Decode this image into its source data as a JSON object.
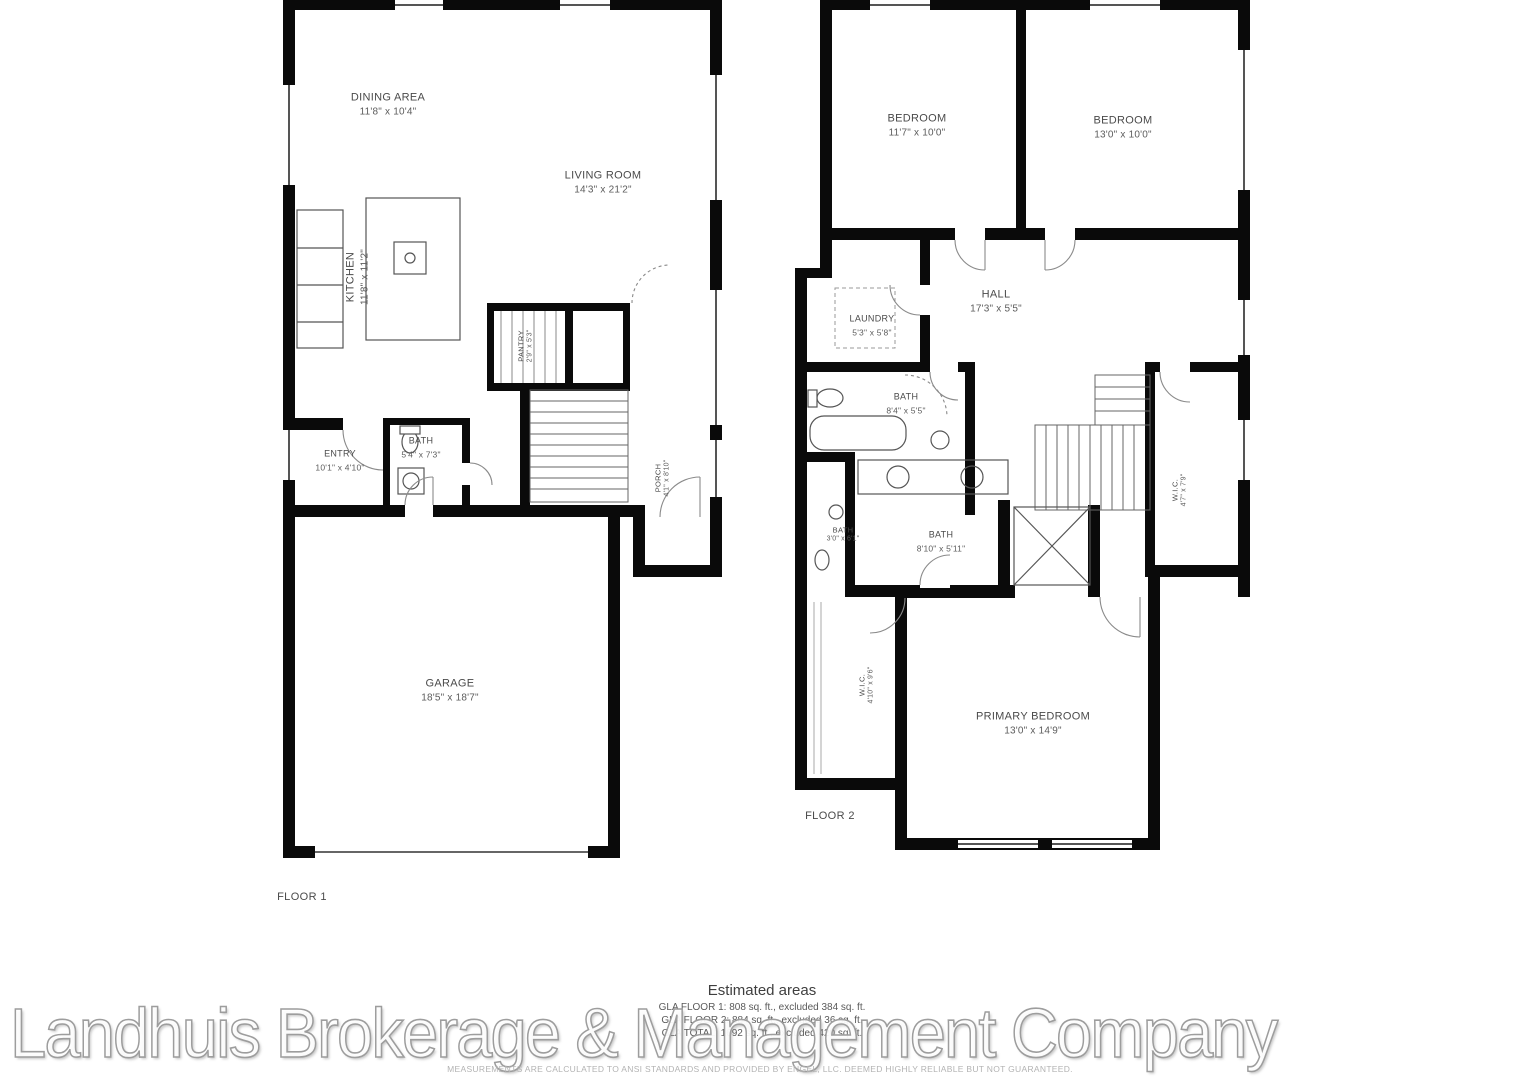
{
  "floor1": {
    "label": "FLOOR 1",
    "rooms": [
      {
        "label": "DINING AREA",
        "dims": "11'8\" x 10'4\""
      },
      {
        "label": "LIVING ROOM",
        "dims": "14'3\" x 21'2\""
      },
      {
        "label": "KITCHEN",
        "dims": "11'8\" x 11'2\""
      },
      {
        "label": "PANTRY",
        "dims": "2'9\" x 5'3\""
      },
      {
        "label": "BATH",
        "dims": "5'4\" x 7'3\""
      },
      {
        "label": "ENTRY",
        "dims": "10'1\" x 4'10\""
      },
      {
        "label": "PORCH",
        "dims": "4'1\" x 8'10\""
      },
      {
        "label": "GARAGE",
        "dims": "18'5\" x 18'7\""
      }
    ]
  },
  "floor2": {
    "label": "FLOOR 2",
    "rooms": [
      {
        "label": "BEDROOM",
        "dims": "11'7\" x 10'0\""
      },
      {
        "label": "BEDROOM",
        "dims": "13'0\" x 10'0\""
      },
      {
        "label": "LAUNDRY",
        "dims": "5'3\" x 5'8\""
      },
      {
        "label": "HALL",
        "dims": "17'3\" x 5'5\""
      },
      {
        "label": "BATH",
        "dims": "8'4\" x 5'5\""
      },
      {
        "label": "BATH",
        "dims": "3'0\" x 6'1\""
      },
      {
        "label": "BATH",
        "dims": "8'10\" x 5'11\""
      },
      {
        "label": "W.I.C.",
        "dims": "4'7\" x 7'9\""
      },
      {
        "label": "W.I.C.",
        "dims": "4'10\" x 9'6\""
      },
      {
        "label": "PRIMARY BEDROOM",
        "dims": "13'0\" x 14'9\""
      }
    ]
  },
  "footer": {
    "estimated_title": "Estimated areas",
    "lines": [
      "GLA FLOOR 1: 808 sq. ft., excluded 384 sq. ft.",
      "GLA FLOOR 2: 884 sq. ft., excluded 36 sq. ft.",
      "GLA TOTAL: 1692 sq. ft., excluded 420 sq. ft."
    ],
    "disclaimer": "MEASUREMENTS ARE CALCULATED TO ANSI STANDARDS AND PROVIDED BY ENGEL, LLC. DEEMED HIGHLY RELIABLE BUT NOT GUARANTEED."
  },
  "watermark": "Landhuis Brokerage & Management Company"
}
